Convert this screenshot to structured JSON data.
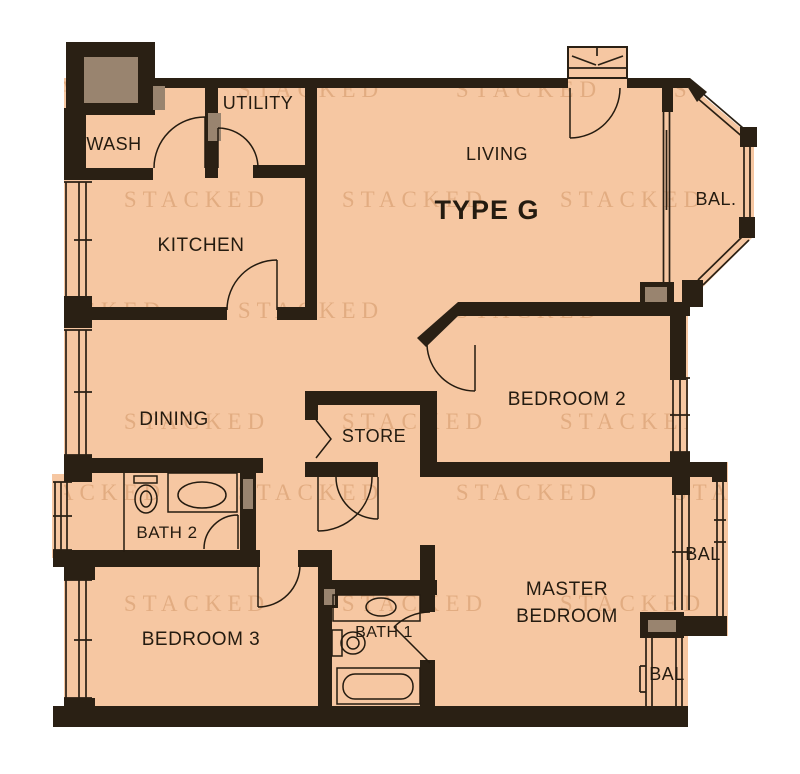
{
  "plan": {
    "type_label": "TYPE G",
    "watermark": "STACKED"
  },
  "rooms": {
    "wash": {
      "label": "WASH"
    },
    "utility": {
      "label": "UTILITY"
    },
    "kitchen": {
      "label": "KITCHEN"
    },
    "living": {
      "label": "LIVING"
    },
    "dining": {
      "label": "DINING"
    },
    "store": {
      "label": "STORE"
    },
    "bedroom2": {
      "label": "BEDROOM 2"
    },
    "bedroom3": {
      "label": "BEDROOM 3"
    },
    "master": {
      "line1": "MASTER",
      "line2": "BEDROOM"
    },
    "bath1": {
      "label": "BATH 1"
    },
    "bath2": {
      "label": "BATH 2"
    },
    "balcony_living": {
      "label": "BAL."
    },
    "balcony_master_upper": {
      "label": "BAL"
    },
    "balcony_master_lower": {
      "label": "BAL"
    }
  },
  "colors": {
    "floor": "#f6c7a2",
    "wall": "#2a2014",
    "shaft": "#99846f",
    "ink": "#241b10",
    "watermark": "#b06a30",
    "background": "#ffffff"
  }
}
